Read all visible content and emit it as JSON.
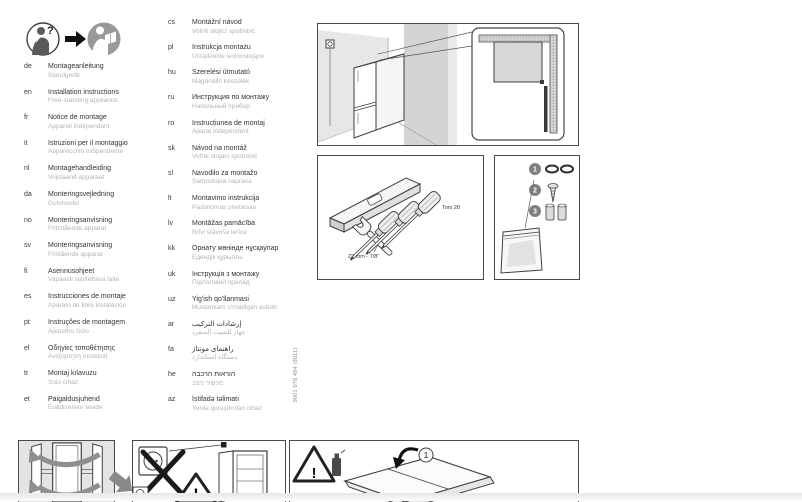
{
  "header": {
    "icons": [
      "question-person-icon",
      "arrow-right-icon",
      "reading-person-icon"
    ],
    "question_mark": "?"
  },
  "languages": {
    "col1": [
      {
        "code": "de",
        "title": "Montageanleitung",
        "subtitle": "Standgerät"
      },
      {
        "code": "en",
        "title": "Installation instructions",
        "subtitle": "Free-standing appliance"
      },
      {
        "code": "fr",
        "title": "Notice de montage",
        "subtitle": "Appareil indépendant"
      },
      {
        "code": "it",
        "title": "Istruzioni per il montaggio",
        "subtitle": "Apparecchio indipendente"
      },
      {
        "code": "nl",
        "title": "Montagehandleiding",
        "subtitle": "Vrijstaand apparaat"
      },
      {
        "code": "da",
        "title": "Monteringsvejledning",
        "subtitle": "Gulvmodel"
      },
      {
        "code": "no",
        "title": "Monteringsanvisning",
        "subtitle": "Frittstående apparat"
      },
      {
        "code": "sv",
        "title": "Monteringsanvisning",
        "subtitle": "Fristående apparat"
      },
      {
        "code": "fi",
        "title": "Asennusohjeet",
        "subtitle": "Vapaasti sijoitettava laite"
      },
      {
        "code": "es",
        "title": "Instrucciones de montaje",
        "subtitle": "Aparato de libre instalación"
      },
      {
        "code": "pt",
        "title": "Instruções de montagem",
        "subtitle": "Aparelho Solo"
      },
      {
        "code": "el",
        "title": "Οδηγίες τοποθέτησης",
        "subtitle": "Ανεξάρτητη συσκευή"
      },
      {
        "code": "tr",
        "title": "Montaj kılavuzu",
        "subtitle": "Solo cihaz"
      },
      {
        "code": "et",
        "title": "Paigaldusjuhend",
        "subtitle": "Eraldiseisev seade"
      }
    ],
    "col2": [
      {
        "code": "cs",
        "title": "Montážní návod",
        "subtitle": "Volně stojící spotřebič"
      },
      {
        "code": "pl",
        "title": "Instrukcja montażu",
        "subtitle": "Urządzenie wolnostojące"
      },
      {
        "code": "hu",
        "title": "Szerelési útmutató",
        "subtitle": "Magánálló készülék"
      },
      {
        "code": "ru",
        "title": "Инструкция по монтажу",
        "subtitle": "Напольный прибор"
      },
      {
        "code": "ro",
        "title": "Instrucțiunea de montaj",
        "subtitle": "Aparat independent"
      },
      {
        "code": "sk",
        "title": "Návod na montáž",
        "subtitle": "Voľne stojací spotrebič"
      },
      {
        "code": "sl",
        "title": "Navodilo za montažo",
        "subtitle": "Samostojna naprava"
      },
      {
        "code": "lt",
        "title": "Montavimo instrukcija",
        "subtitle": "Pastatomas prietaisas"
      },
      {
        "code": "lv",
        "title": "Montāžas pamācība",
        "subtitle": "Brīvi stāvoša ierīce"
      },
      {
        "code": "kk",
        "title": "Орнату жөнінде нұсқаулар",
        "subtitle": "Едендік құрылғы"
      },
      {
        "code": "uk",
        "title": "Інструкція з монтажу",
        "subtitle": "Підлоговий прилад"
      },
      {
        "code": "uz",
        "title": "Yig'ish qo'llanmasi",
        "subtitle": "Mustahkam o'rnatilgan asbob"
      },
      {
        "code": "ar",
        "title": "إرشادات التركيب",
        "subtitle": "جهاز للتثبيت المنفرد",
        "rtl": true
      },
      {
        "code": "fa",
        "title": "راهنمای مونتاژ",
        "subtitle": "دستگاه استاندارد",
        "rtl": true
      },
      {
        "code": "he",
        "title": "הוראות הרכבה",
        "subtitle": "מכשיר ניצב",
        "rtl": true
      },
      {
        "code": "az",
        "title": "İstifadə təlimatı",
        "subtitle": "Yerdə quraşdırılan cihaz"
      }
    ]
  },
  "part_number": "9001 078 484 (9811)",
  "tools_panel": {
    "torx_label": "Torx 20",
    "wrench_label": "22 mm - 7/8\""
  },
  "parts_panel": {
    "item1": "1",
    "item2": "2",
    "item3": "3"
  },
  "unpack_panel": {
    "step1": "1",
    "warning_mark": "!"
  },
  "power_panel": {
    "warning_mark": "!"
  },
  "colors": {
    "line": "#3f3f3f",
    "wall_gray": "#d4d4d4",
    "subtitle_gray": "#b4b4b4",
    "arrow_gray": "#8f8f8f",
    "panel_bg_gray": "#e4e4e4"
  }
}
